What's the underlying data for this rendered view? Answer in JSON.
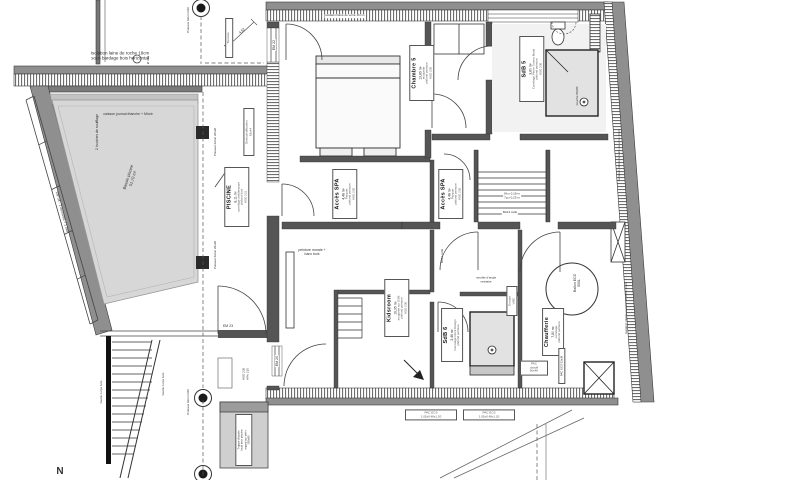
{
  "colors": {
    "wall_gray": "#8f8f8f",
    "pool_gray": "#d7d7d7",
    "line": "#2a2a2a"
  },
  "labels": {
    "iso_roche_1": "Isolation laine de roche 18cm",
    "iso_roche_2": "sous bardage bois horizontal",
    "top_note": "isolation laine de verre 16 cm",
    "terrasse": "Terrasse",
    "poteau_d20": "Poteaux béton D20",
    "dim_462": "4,62",
    "em22": "EM 22",
    "em23": "EM 23",
    "em20": "EM 20",
    "diam160": "Ø 160",
    "caisson": "caisson journal étanche + Miroir",
    "bouches": "2 bouches de soufflage",
    "bassin_1": "Bassin piscine",
    "bassin_2": "51,70 m²",
    "em04": "EM 04 - 2 ouvrants + 1 fixe",
    "poteaux_2020": "Poteaux béton 20x20",
    "deshu_1": "Déshumidificateur",
    "deshu_2": "82x44",
    "stair_note_1": "8h x 0,18 m",
    "stair_note_2": "7g x 0,25 m",
    "ba13": "BA13 collé",
    "peinture_1": "peinture murale +",
    "peinture_2": "banc bois",
    "meuble_1": "meuble d'angle",
    "meuble_2": "vestiaire",
    "ballon_1": "Ballon ECS",
    "ballon_2": "500L",
    "vmc_1": "Groupe",
    "vmc_2": "VMC",
    "pac_chauff_1": "PAC",
    "pac_chauff_2": "chauff",
    "pac_chauff_3": "60x46",
    "pac_ecs_small": "PAC ECS 53x38",
    "pac_ecs_1": "PAC ECS",
    "pac_ecs_2": "1.05x0.48x1.20",
    "douche": "douche 80x80",
    "iso_int": "Isolation intérieure laine de verre 16cm",
    "hso235": "HSO 235",
    "hrv215": "HRv 215",
    "garde": "Garde corps bois",
    "trappe_1": "Trappe d'accès",
    "trappe_2": "local tech piscine",
    "trappe_3": "regard sur vérin",
    "trappe_4": "150x90",
    "north": "N"
  },
  "rooms": {
    "piscine": {
      "name": "PISCINE",
      "area": "8,11 m²",
      "l1": "carrelage antidérapant",
      "l2": "plafond bois",
      "l3": "HSO 231"
    },
    "chambre5": {
      "name": "Chambre 5",
      "area": "13,89 m²",
      "l1": "moquette",
      "l2": "plafond peinture",
      "l3": "HSO 230"
    },
    "sdb5": {
      "name": "SdB 5",
      "area": "3,80 m²",
      "l1": "Carrelage Pierre Tortora Matal",
      "l2": "plafond peinture",
      "l3": "HSO 230"
    },
    "acces_spa": {
      "name": "Accès SPA",
      "area": "4,48 m²",
      "l1": "Parquet",
      "l2": "plafond peinture",
      "l3": "HSO 230"
    },
    "kidsroom": {
      "name": "Kidsroom",
      "area": "16,35 m²",
      "l1": "moquette sur OSB",
      "l2": "plafond peinture",
      "l3": "HSO 230"
    },
    "sdb6": {
      "name": "SdB 6",
      "area": "3,46 m²",
      "l1": "Carrelage Rock Design",
      "l2": "plafond peinture",
      "l3": ""
    },
    "chaufferie": {
      "name": "Chaufferie",
      "area": "7,80 m²",
      "l1": "carrelage",
      "l2": "plafond peinture",
      "l3": ""
    }
  }
}
